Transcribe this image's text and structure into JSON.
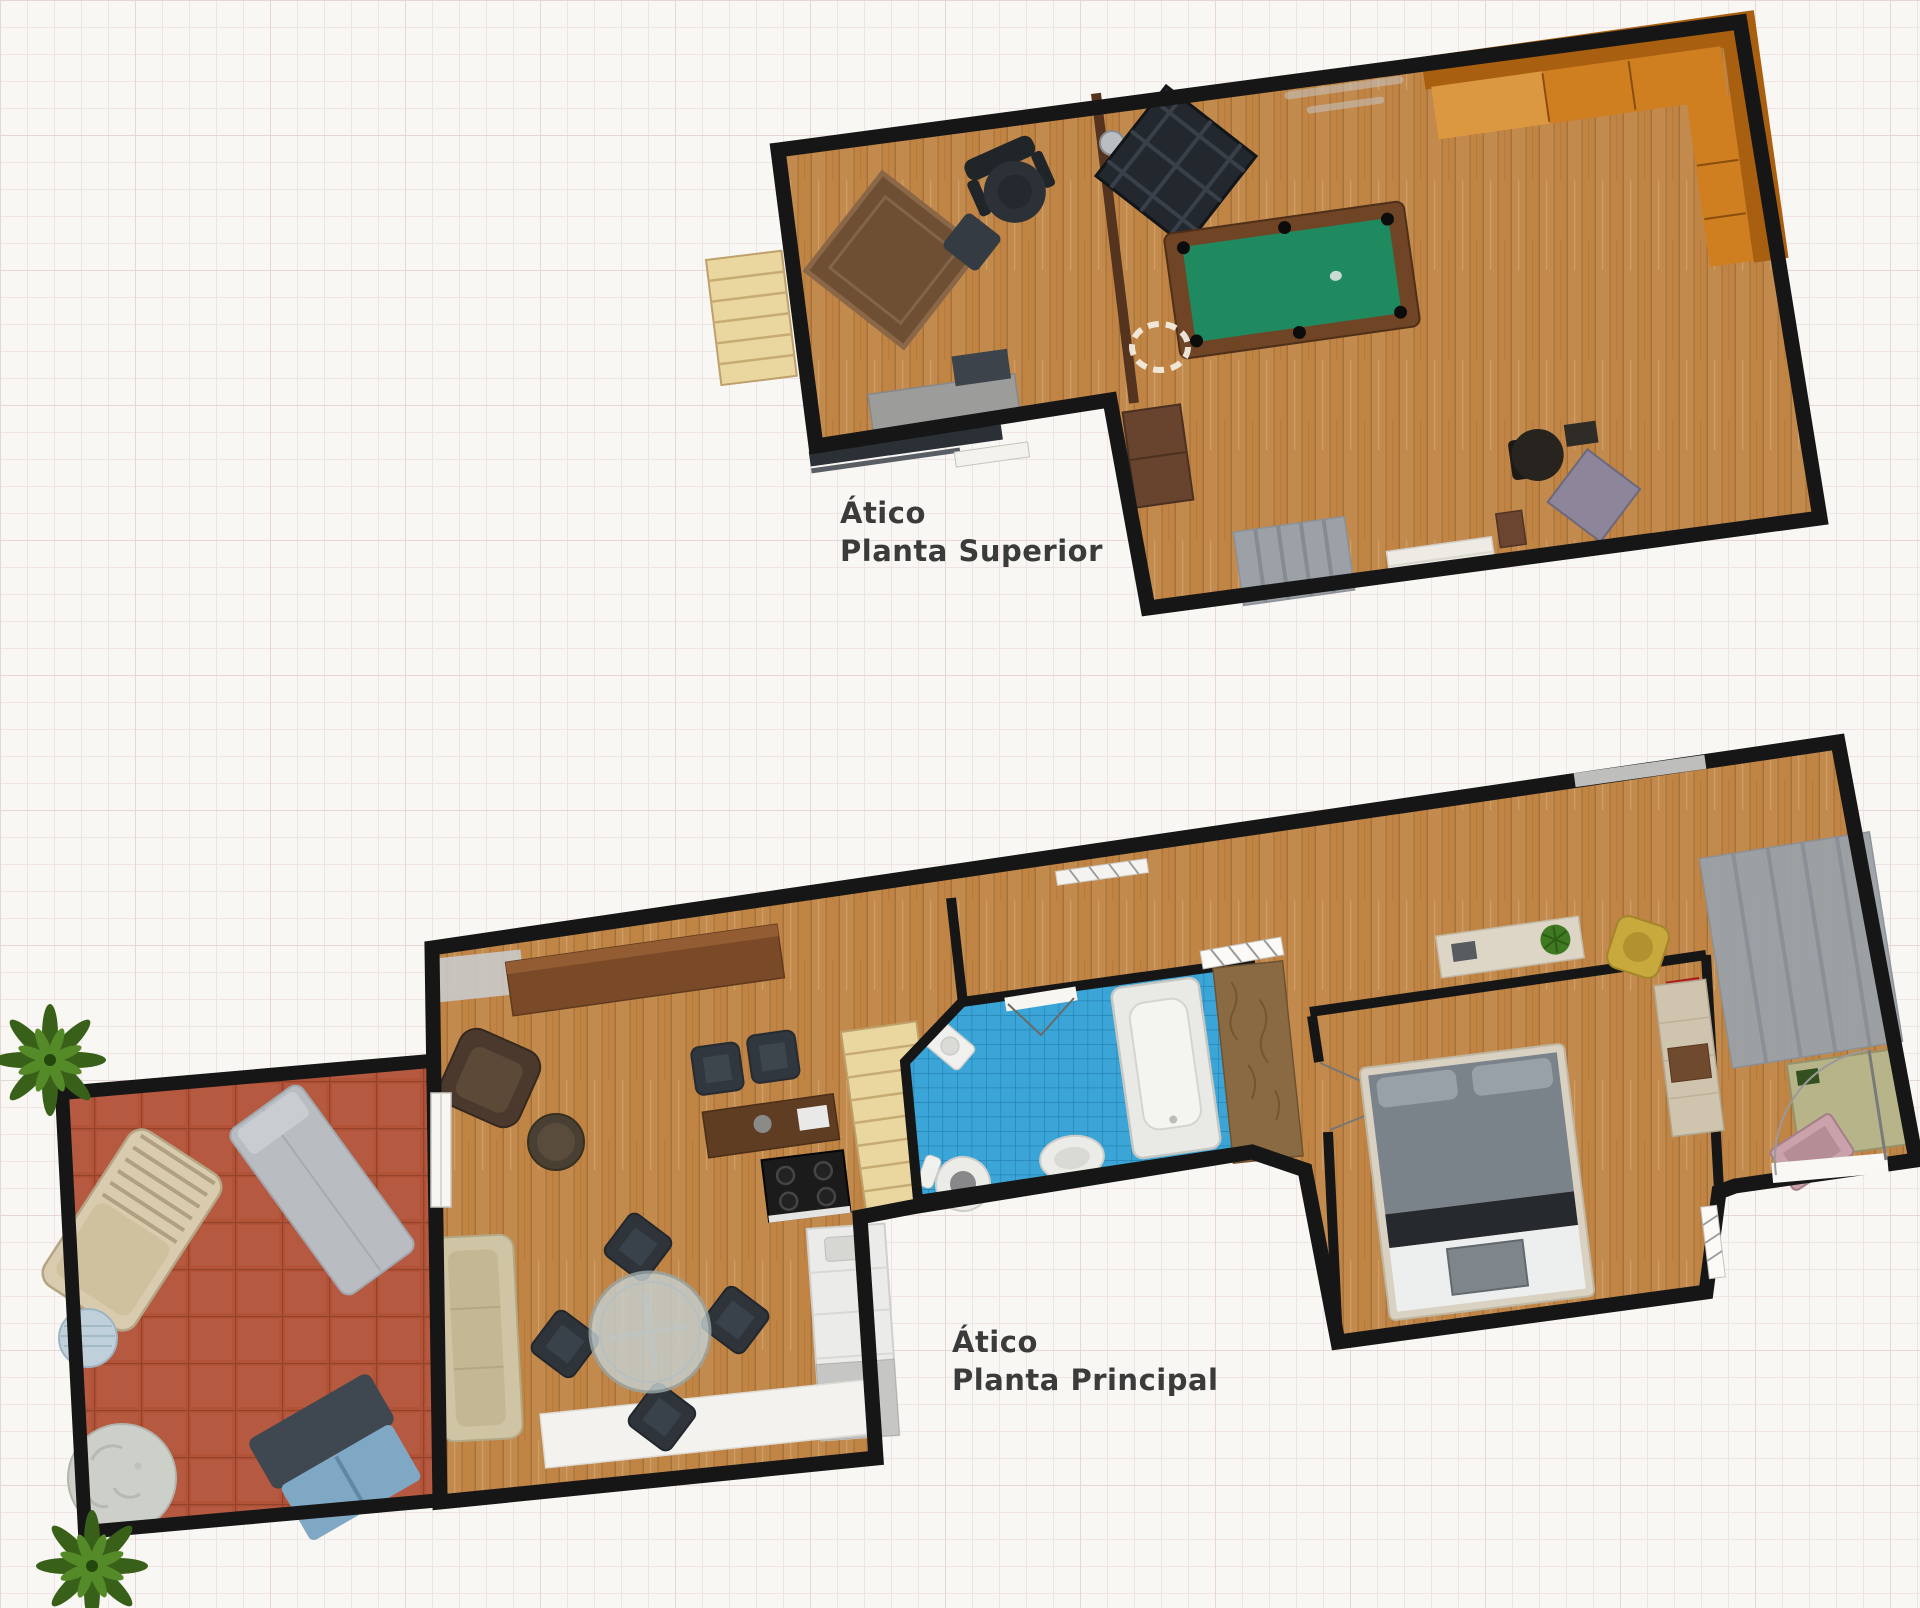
{
  "page": {
    "width": 1920,
    "height": 1608
  },
  "css_vars": {
    "paper": "#f9f7f3",
    "grid-line": "#efe4e3",
    "grid-strong": "#e6d7d6"
  },
  "labels": {
    "upper": {
      "line1": "Ático",
      "line2": "Planta Superior"
    },
    "main": {
      "line1": "Ático",
      "line2": "Planta Principal"
    },
    "color": "#3b3b3b"
  },
  "colors": {
    "wall": "#161616",
    "wood_floor": "#c08445",
    "terrace_brick": "#b25338",
    "bathroom_tile": "#3aa5d6",
    "pool_felt": "#1f8a60",
    "pool_frame": "#6f4526",
    "sofa_orange": "#cf7f20",
    "sofa_orange_dark": "#a85f10",
    "stairs_wood": "#ead79f",
    "rug_gray": "#9ba1a7",
    "office_rug_brown": "#6f4f33",
    "divider_brown": "#54331f",
    "plant_green": "#386019",
    "bed_duvet": "#7b838a",
    "counter_white": "#ebebe9",
    "terrace_stone": "#cdcfc9",
    "glass_table": "#c6d0d0",
    "beige_sofa": "#cfc5a4",
    "wicker": "#d8cbae",
    "lounger_gray": "#b9bdc1",
    "chair_dark": "#2e343a",
    "desk_brown": "#5f3d22",
    "sideboard_brown": "#7a4a28",
    "olive_desk": "#b7b489",
    "yellow_chair": "#c8a93e",
    "red_item": "#cc2424",
    "pink_tray": "#c9a2ab"
  }
}
